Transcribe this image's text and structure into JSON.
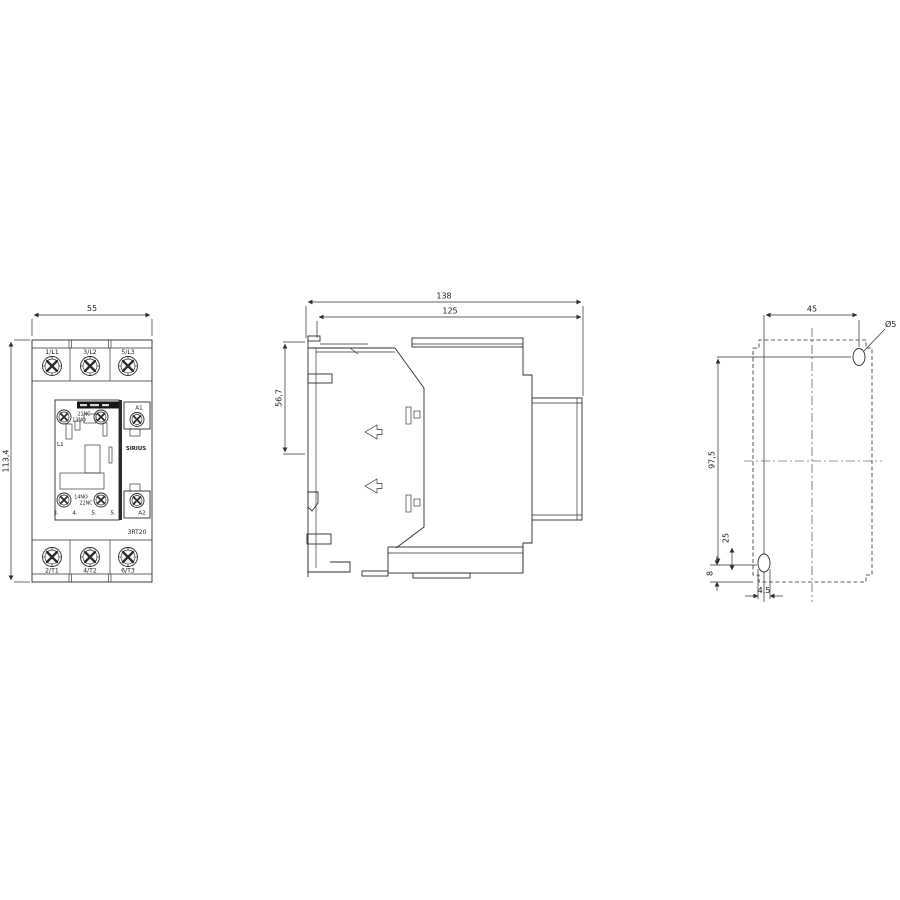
{
  "front_view": {
    "dim_width": "55",
    "dim_height": "113,4",
    "terminals_top": [
      "1/L1",
      "3/L2",
      "5/L3"
    ],
    "terminals_bottom": [
      "2/T1",
      "4/T2",
      "6/T3"
    ],
    "aux_contact_top": {
      "upper": "21NC",
      "lower": "13NO"
    },
    "aux_contact_bottom": {
      "upper": "14NO",
      "lower": "22NC"
    },
    "coil_terminal_top": "A1",
    "coil_terminal_bottom": "A2",
    "coil_marking": "L1",
    "brand": "SIRIUS",
    "series": "3RT20",
    "size_numbers": [
      "3.",
      "4.",
      "5.",
      "5."
    ]
  },
  "side_view": {
    "dim_depth_total": "138",
    "dim_depth_front": "125",
    "dim_top_to_rail": "56,7"
  },
  "drill_plan": {
    "dim_horizontal_spacing": "45",
    "dim_vertical_spacing": "97,5",
    "dim_slot_length": "25",
    "dim_bottom_offset": "8",
    "dim_slot_width": "4,5",
    "hole_diameter": "Ø5"
  }
}
